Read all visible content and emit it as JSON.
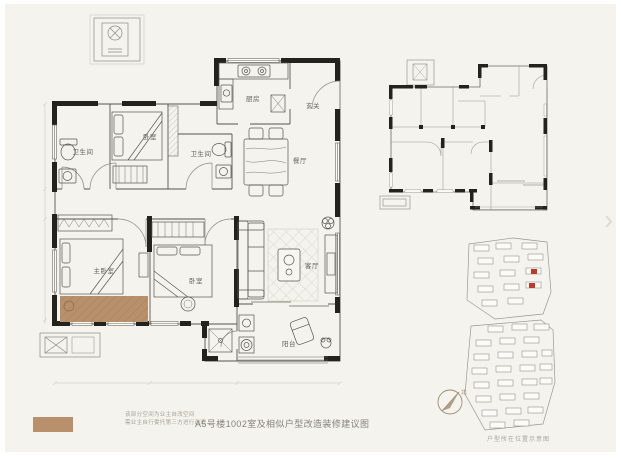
{
  "window": {
    "background_color": "#f4f3ee",
    "frame_color": "#ffffff"
  },
  "title": "A5号楼1002室及相似户型改造装修建议图",
  "legend": {
    "swatch_color": "#b8906b",
    "note_line1": "该部分空间为业主自改空间",
    "note_line2": "需业主自行委托第三方进行改造"
  },
  "floor_plan": {
    "highlight_color": "#b8906b",
    "wall_color": "#23221d",
    "rooms": [
      {
        "id": "bathroom-1",
        "label": "卫生间"
      },
      {
        "id": "bedroom-1",
        "label": "卧室"
      },
      {
        "id": "bathroom-2",
        "label": "卫生间"
      },
      {
        "id": "kitchen",
        "label": "厨房"
      },
      {
        "id": "entry",
        "label": "玄关"
      },
      {
        "id": "dining",
        "label": "餐厅"
      },
      {
        "id": "master-bedroom",
        "label": "主卧室"
      },
      {
        "id": "bedroom-2",
        "label": "卧室"
      },
      {
        "id": "living-room",
        "label": "客厅"
      },
      {
        "id": "balcony",
        "label": "阳台"
      }
    ]
  },
  "site_plan": {
    "caption": "户型所在位置示意图",
    "compass_label": "北",
    "highlight_color": "#c03a2b"
  },
  "carousel": {
    "next_label": "›"
  }
}
